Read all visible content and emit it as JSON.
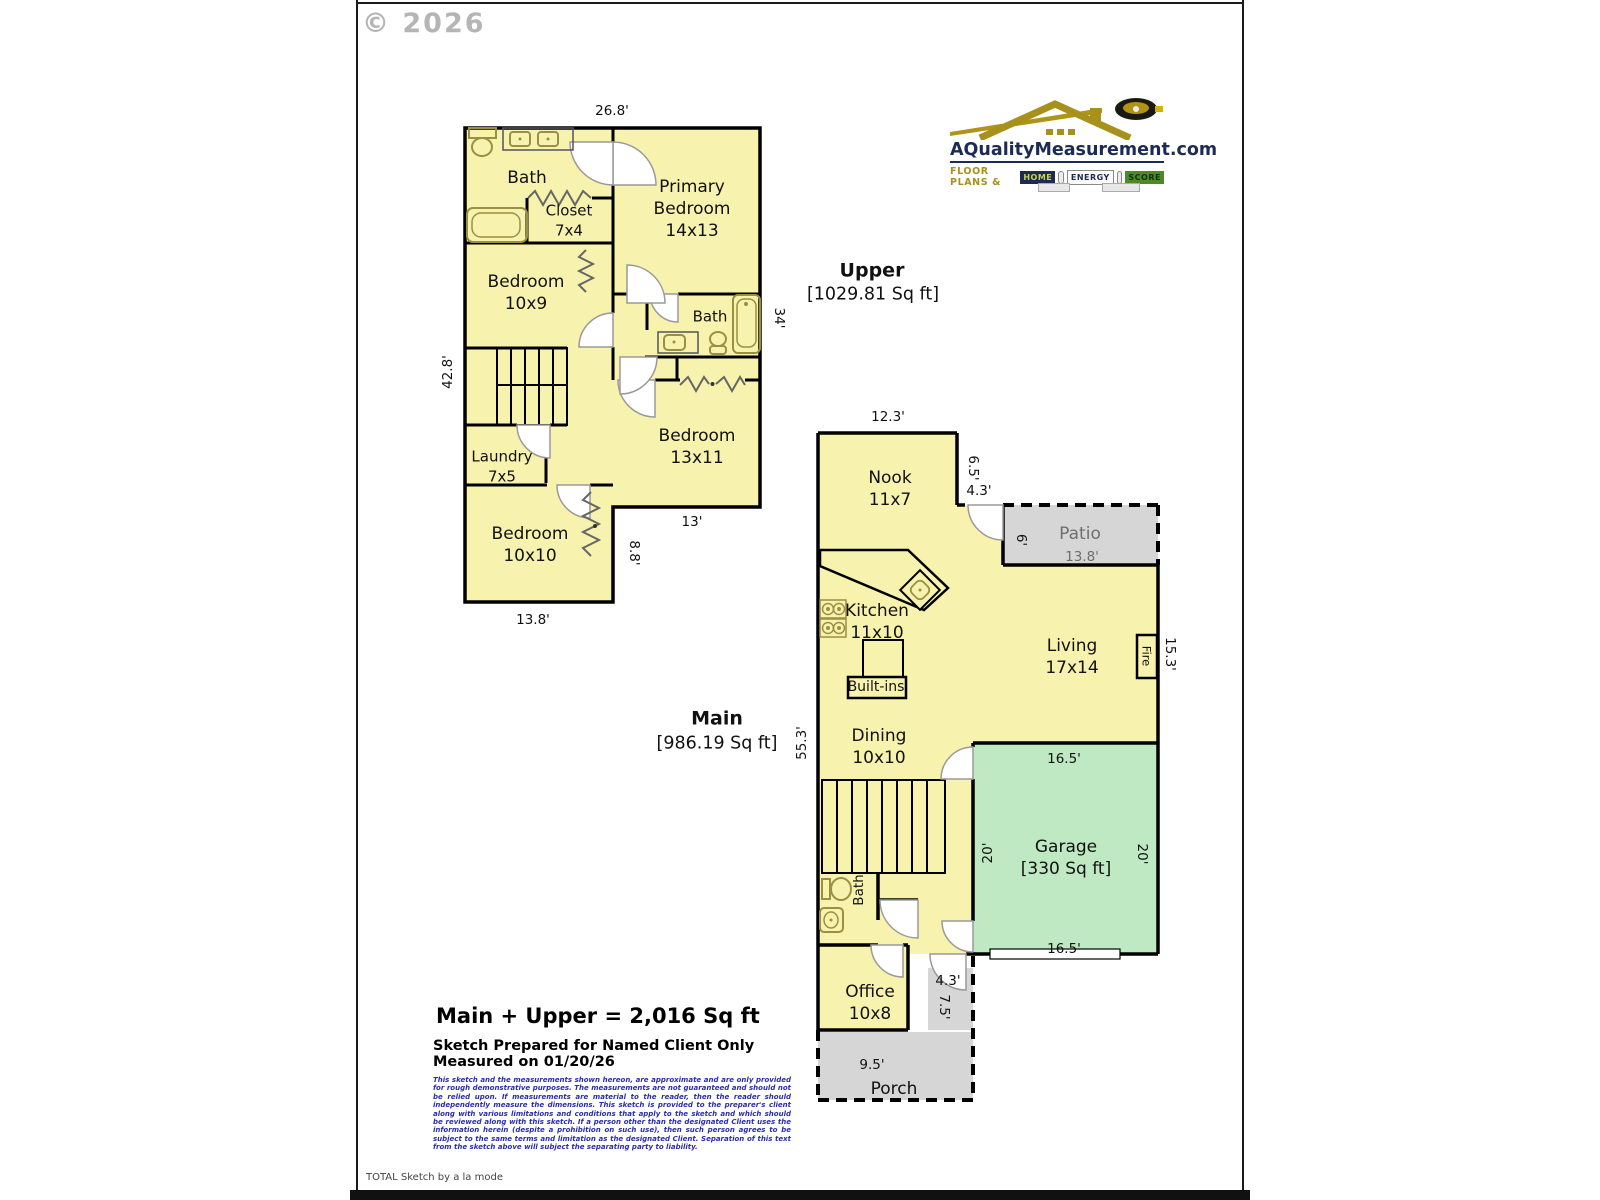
{
  "meta": {
    "copyright": "© 2026",
    "footer": "TOTAL Sketch by a la mode"
  },
  "logo": {
    "site": "AQualityMeasurement.com",
    "tagline": "Floor Plans &",
    "badge_home": "Home",
    "badge_energy": "Energy",
    "badge_score": "Score"
  },
  "upper": {
    "title": "Upper",
    "area": "[1029.81 Sq ft]",
    "bath_top": "Bath",
    "closet": "Closet\n7x4",
    "primary_bedroom": "Primary\nBedroom\n14x13",
    "bedroom_10x9": "Bedroom\n10x9",
    "bath_mid": "Bath",
    "bedroom_13x11": "Bedroom\n13x11",
    "laundry": "Laundry\n7x5",
    "bedroom_10x10": "Bedroom\n10x10",
    "dim_top": "26.8'",
    "dim_left": "42.8'",
    "dim_right": "34'",
    "dim_bottom_right": "13'",
    "dim_step": "8.8'",
    "dim_bottom": "13.8'"
  },
  "main": {
    "title": "Main",
    "area": "[986.19 Sq ft]",
    "nook": "Nook\n11x7",
    "patio": "Patio",
    "patio_dim": "13.8'",
    "kitchen": "Kitchen\n11x10",
    "living": "Living\n17x14",
    "builtins": "Built-ins",
    "dining": "Dining\n10x10",
    "garage": "Garage\n[330 Sq ft]",
    "bath": "Bath",
    "fire": "Fire",
    "office": "Office\n10x8",
    "porch": "Porch",
    "dim_nook_top": "12.3'",
    "dim_nook_right": "6.5'",
    "dim_nook_step": "4.3'",
    "dim_patio_left": "6'",
    "dim_living_right": "15.3'",
    "dim_left": "55.3'",
    "dim_garage_top": "16.5'",
    "dim_garage_bottom": "16.5'",
    "dim_garage_left": "20'",
    "dim_garage_right": "20'",
    "dim_entry_w": "4.3'",
    "dim_entry_h": "7.5'",
    "dim_porch": "9.5'"
  },
  "summary": {
    "total": "Main + Upper = 2,016 Sq ft",
    "prepared": "Sketch Prepared for Named Client Only",
    "measured": "Measured on 01/20/26",
    "disclaimer": "This sketch and the measurements shown hereon, are approximate and are only provided for rough demonstrative purposes. The measurements are not guaranteed and should not be relied upon. If measurements are material to the reader, then the reader should independently measure the dimensions. This sketch is provided to the preparer's client along with various limitations and conditions that apply to the sketch and which should be reviewed along with this sketch. If a person other than the designated Client uses the information herein (despite a prohibition on such use), then such person agrees to be subject to the same terms and limitation as the designated Client. Separation of this text from the sketch above will subject the separating party to liability."
  },
  "colors": {
    "room_fill": "#f7f3ae",
    "garage_fill": "#bfe9c2",
    "outdoor_fill": "#d6d6d6",
    "wall": "#000000",
    "fixture": "#9a9043",
    "logo_navy": "#1c2b55",
    "logo_gold": "#a8901c",
    "disclaimer_blue": "#2b2bb0"
  }
}
